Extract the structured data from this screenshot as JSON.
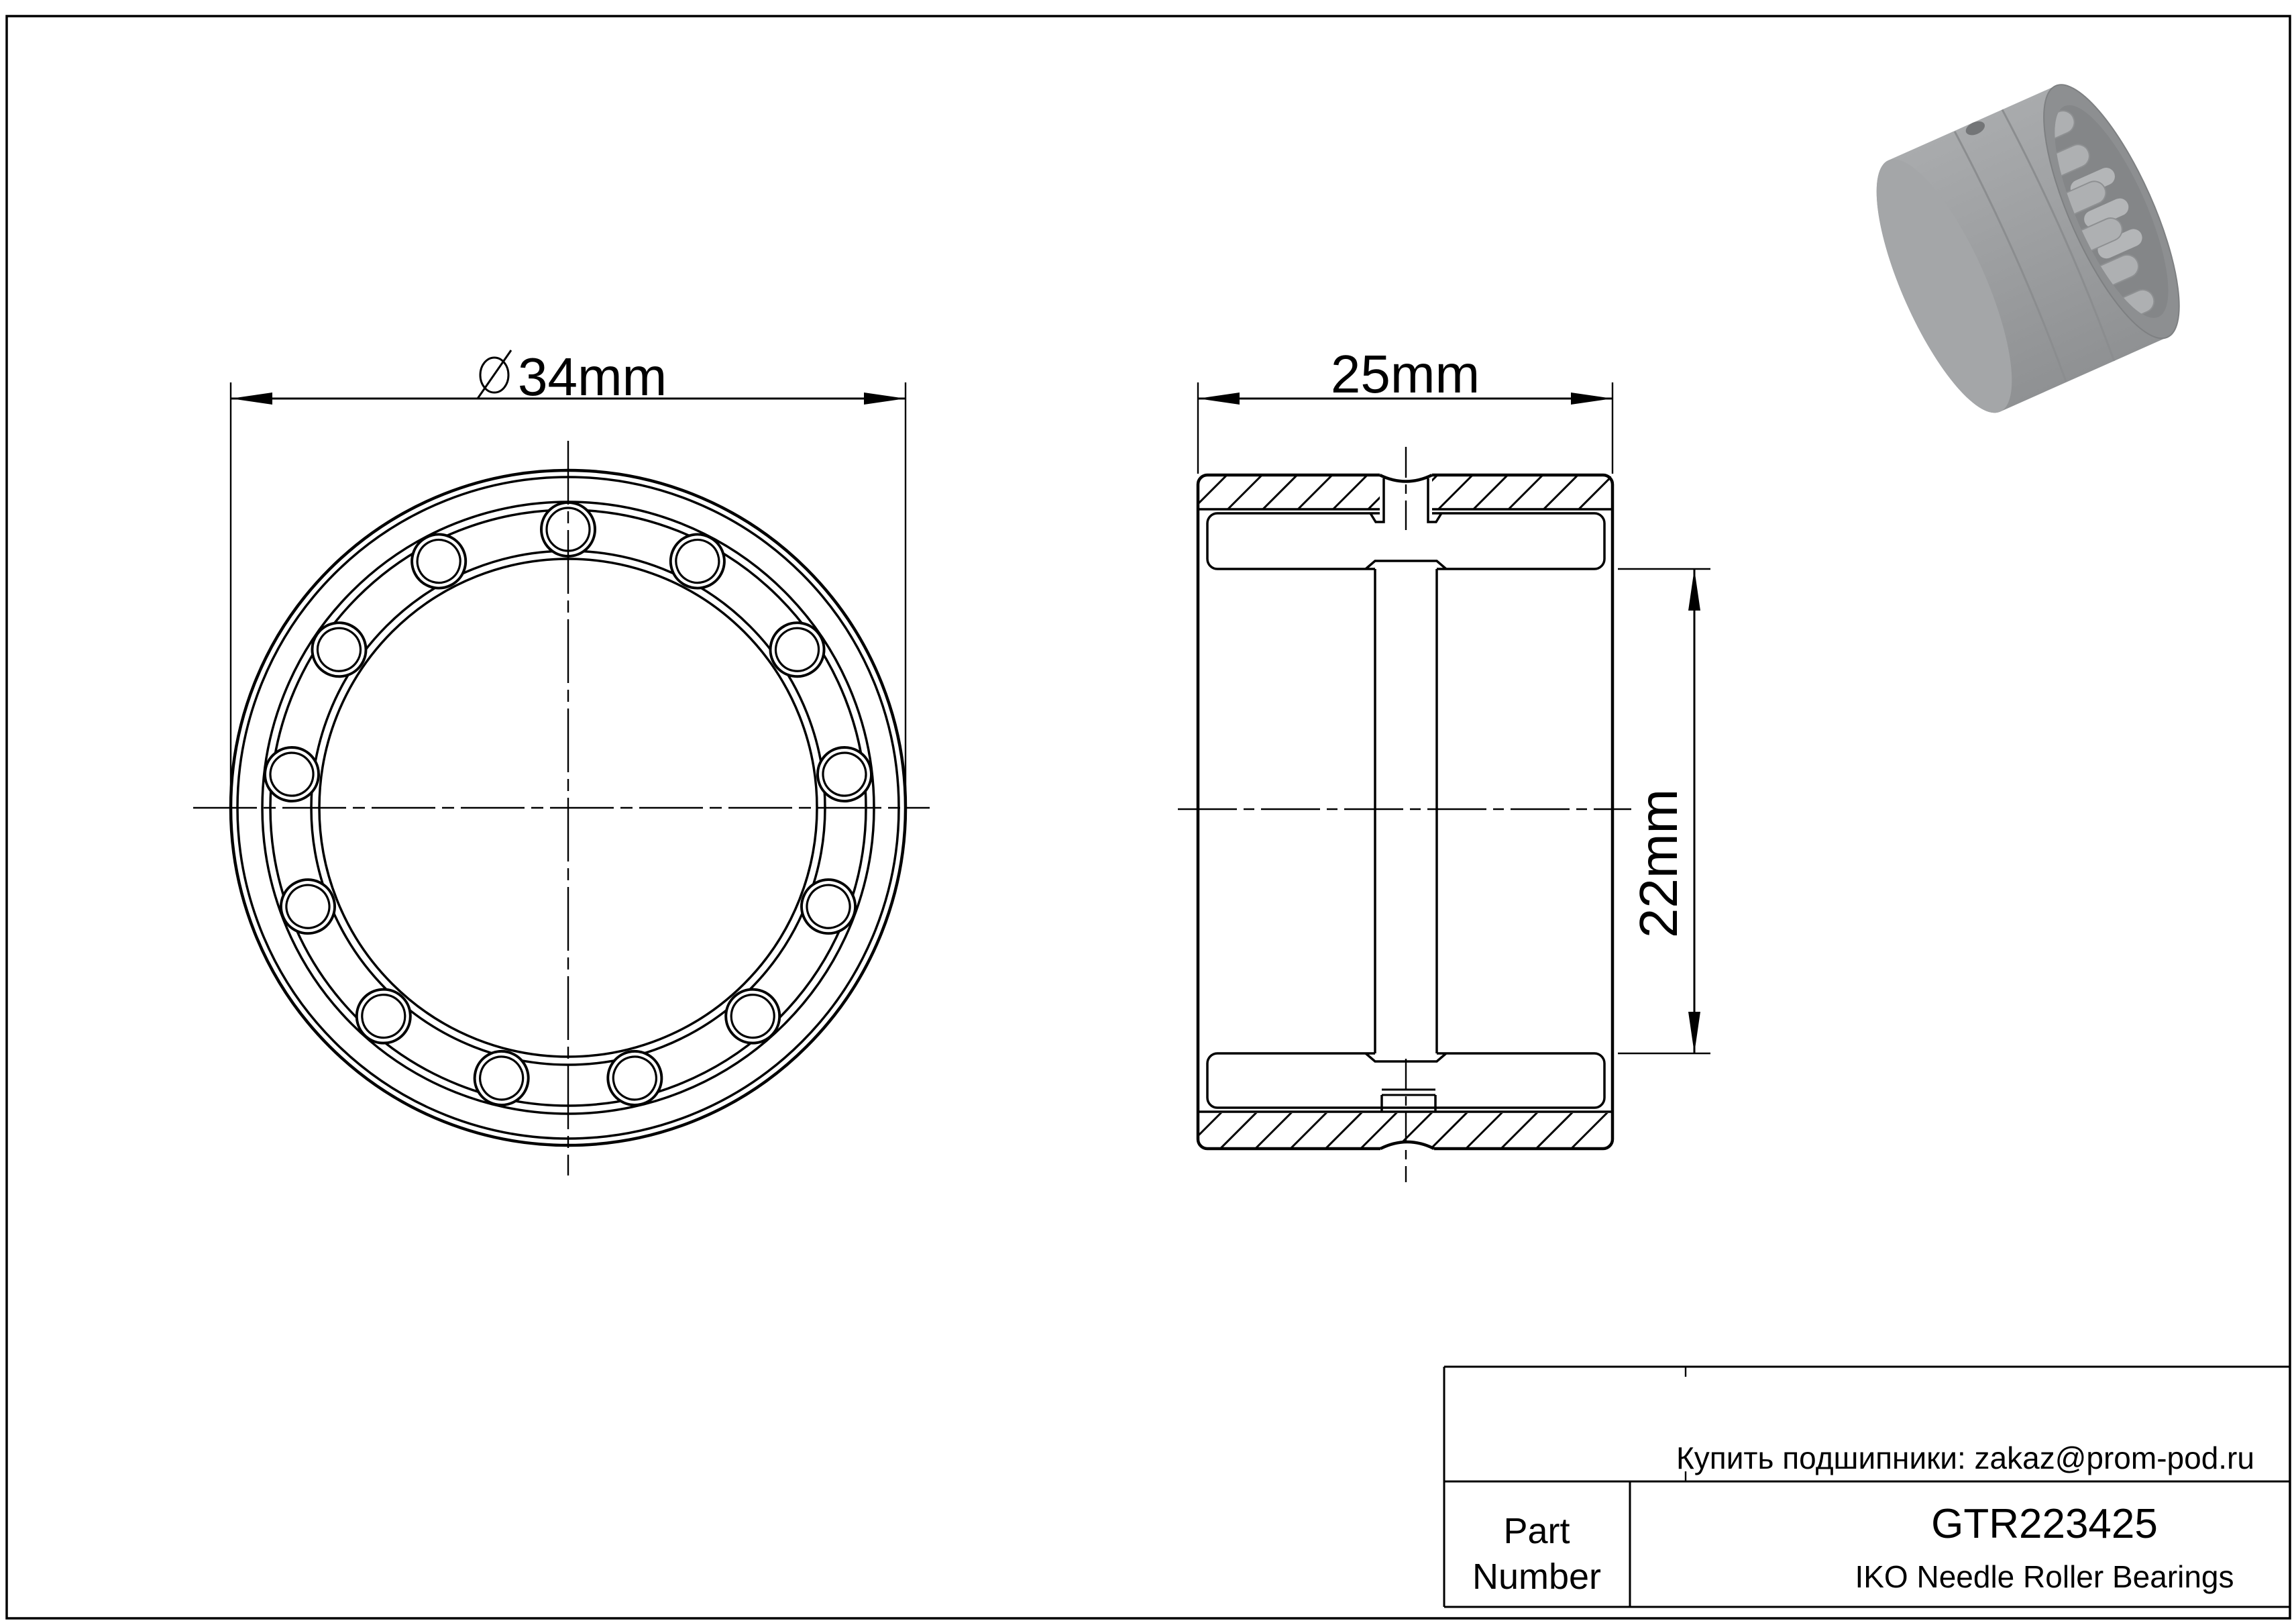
{
  "dimensions": {
    "outer_diameter_value": "34mm",
    "width_value": "25mm",
    "bore_value": "22mm"
  },
  "front_view": {
    "roller_count": 13
  },
  "title_block": {
    "contact": "Купить подшипники: zakaz@prom-pod.ru",
    "part_label_line1": "Part",
    "part_label_line2": "Number",
    "part_number": "GTR223425",
    "product_line": "IKO Needle Roller Bearings"
  },
  "colors": {
    "line": "#000000",
    "paper": "#ffffff",
    "render_gray": "#9b9d9f"
  }
}
